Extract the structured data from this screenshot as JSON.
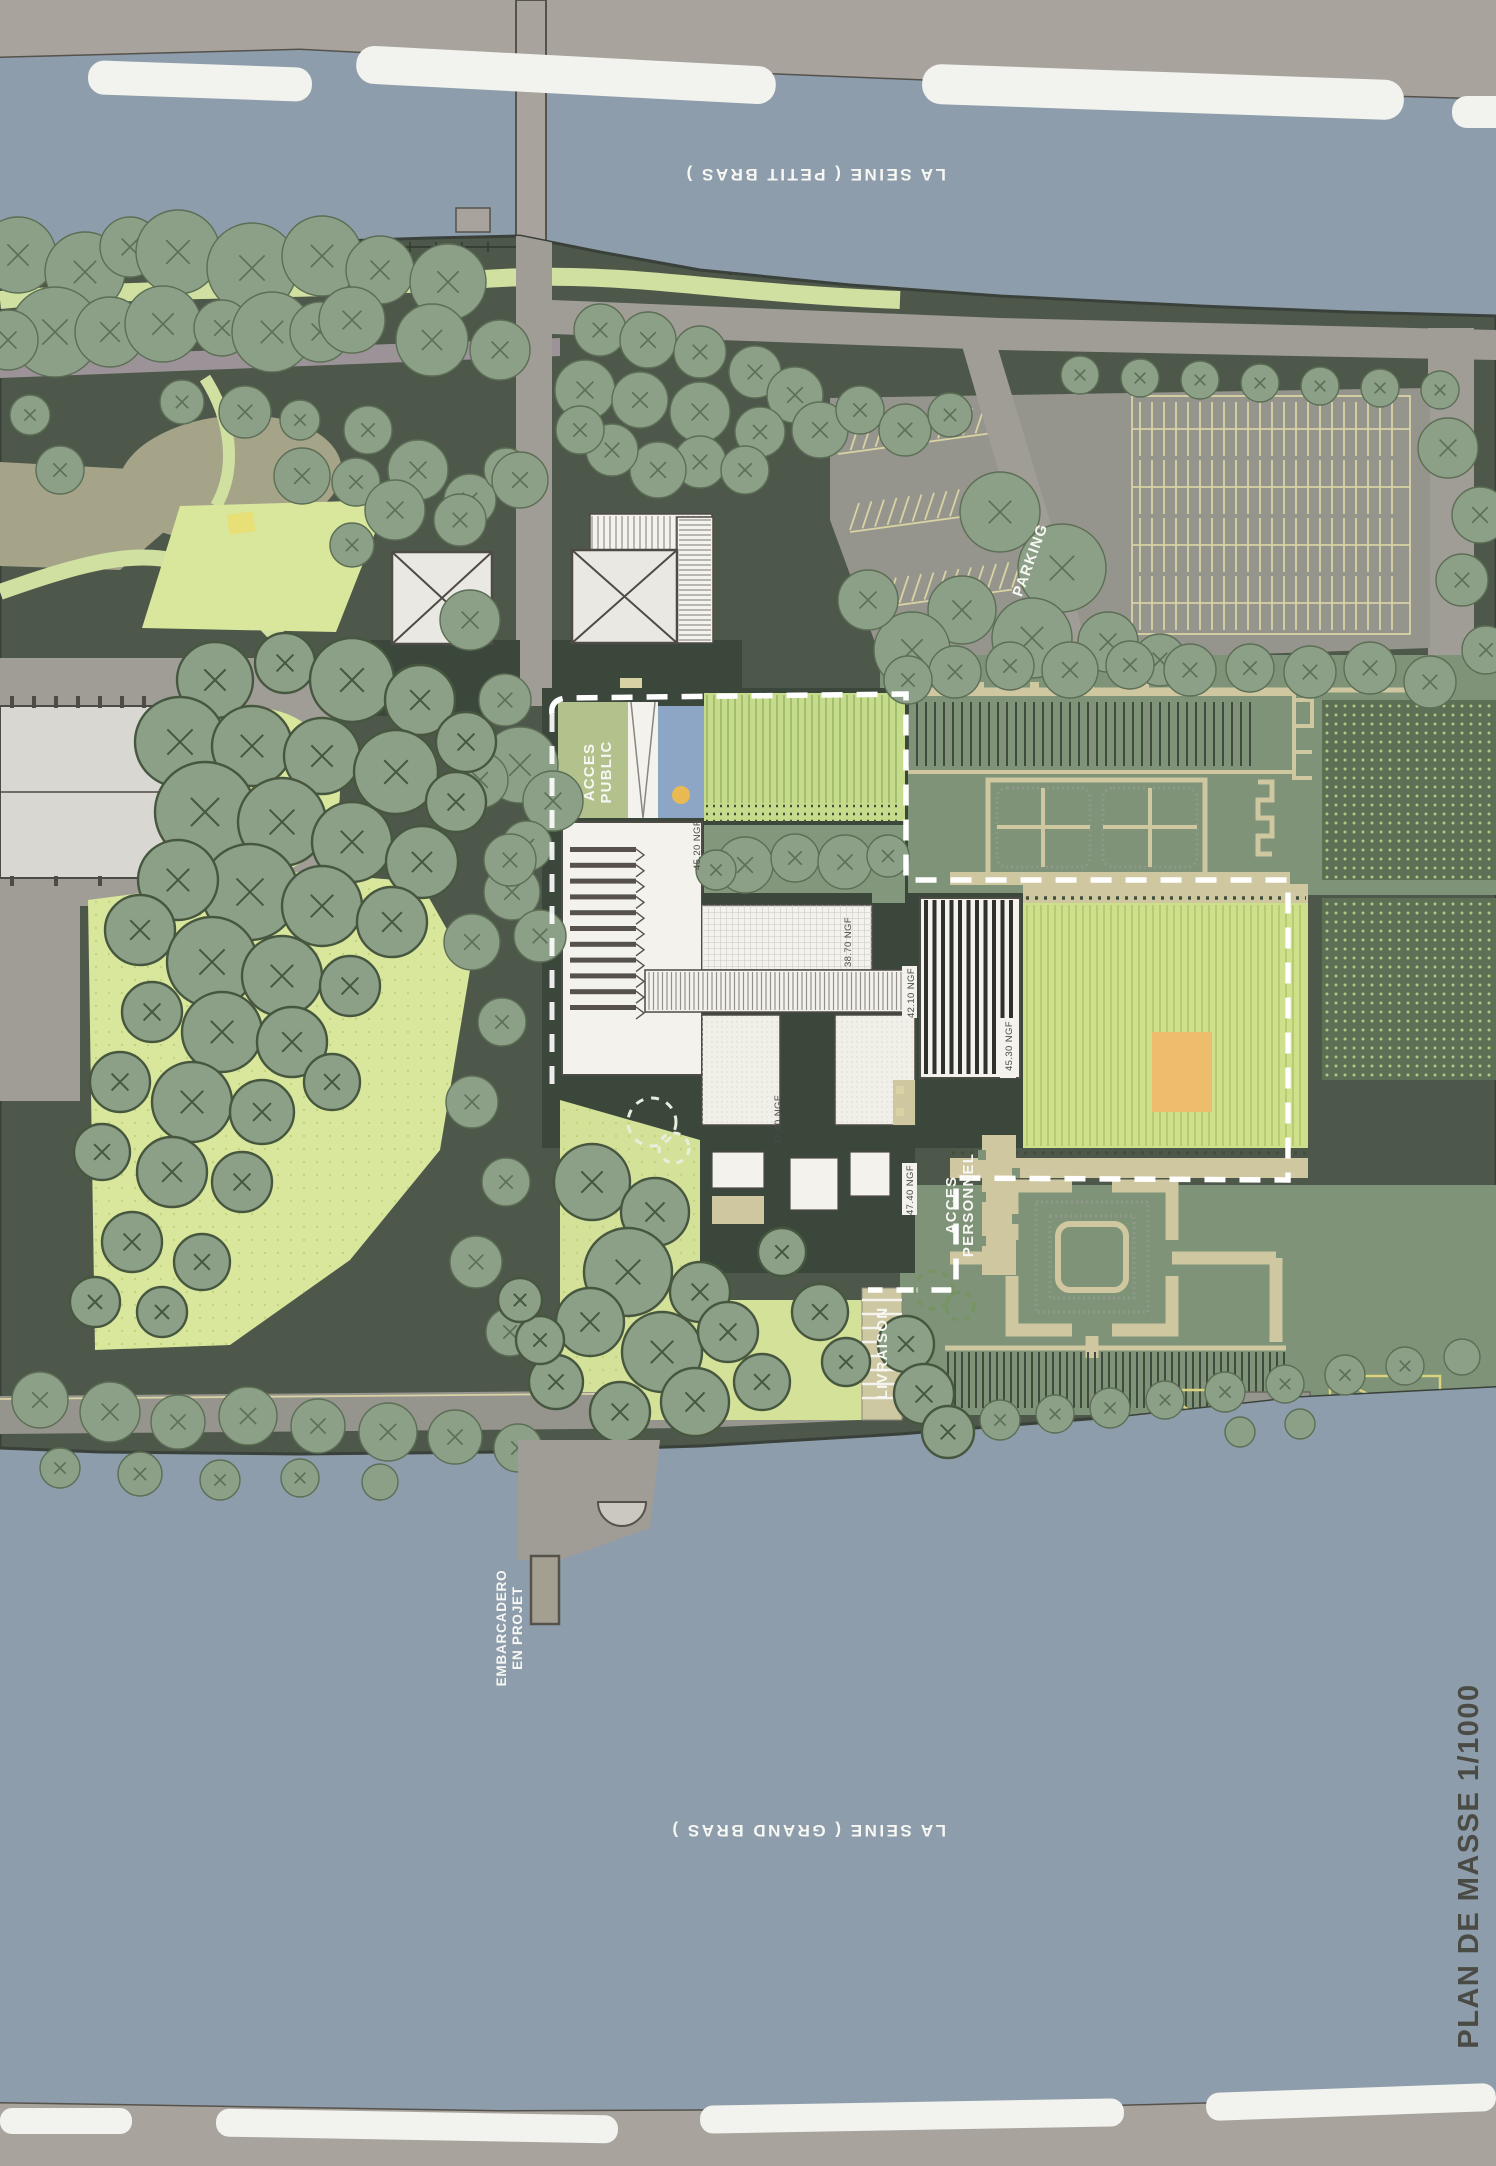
{
  "drawing": {
    "title": "PLAN DE MASSE 1/1000"
  },
  "rivers": {
    "north": "LA SEINE ( PETIT BRAS )",
    "south": "LA SEINE ( GRAND BRAS )"
  },
  "labels": {
    "parking": "PARKING",
    "acces_public": [
      "ACCES",
      "PUBLIC"
    ],
    "acces_personnel": [
      "ACCES",
      "PERSONNEL"
    ],
    "livraison": "LIVRAISON",
    "embarcadero": [
      "EMBARCADERO",
      "EN PROJET"
    ]
  },
  "elevations": [
    "45.20 NGF",
    "38.70 NGF",
    "42.10 NGF",
    "45.30 NGF",
    "47.40 NGF",
    "47.40 NGF"
  ],
  "colors": {
    "paper": "#b5b4ae",
    "band": "#a8a39c",
    "river": "#8e9dab",
    "dash": "#f2f2ee",
    "island": "#4d574a",
    "shore": "#39413a",
    "tree": "#8ba087",
    "treedark": "#47573f",
    "treeline": "#5c6e55",
    "pathlight": "#cfe0a0",
    "lawn": "#d9e79c",
    "clearing": "#a5a489",
    "mauve": "#9c9398",
    "road": "#a09d96",
    "asphalt": "#95958d",
    "stall": "#d8d2a4",
    "white": "#f3f2ed",
    "line": "#4e4a44",
    "plinth": "#3c473c",
    "sage": "#7e9377",
    "rowline": "#414b3d",
    "tan": "#cfc7a0",
    "dotblock": "#5d6f54",
    "dotlight": "#aec984",
    "field": "#cfe08c",
    "fieldstripe": "#b7cc6f",
    "orange": "#edbc6d",
    "pool": "#8ea6c6",
    "poolspot": "#e9b952",
    "textdark": "#4b4b45",
    "labelwhite": "#f7f7f3",
    "hedge": "#8f998a",
    "bright": "#c6db8b",
    "brightrow": "#9ab86a",
    "grayroof": "#d8d7d1"
  }
}
